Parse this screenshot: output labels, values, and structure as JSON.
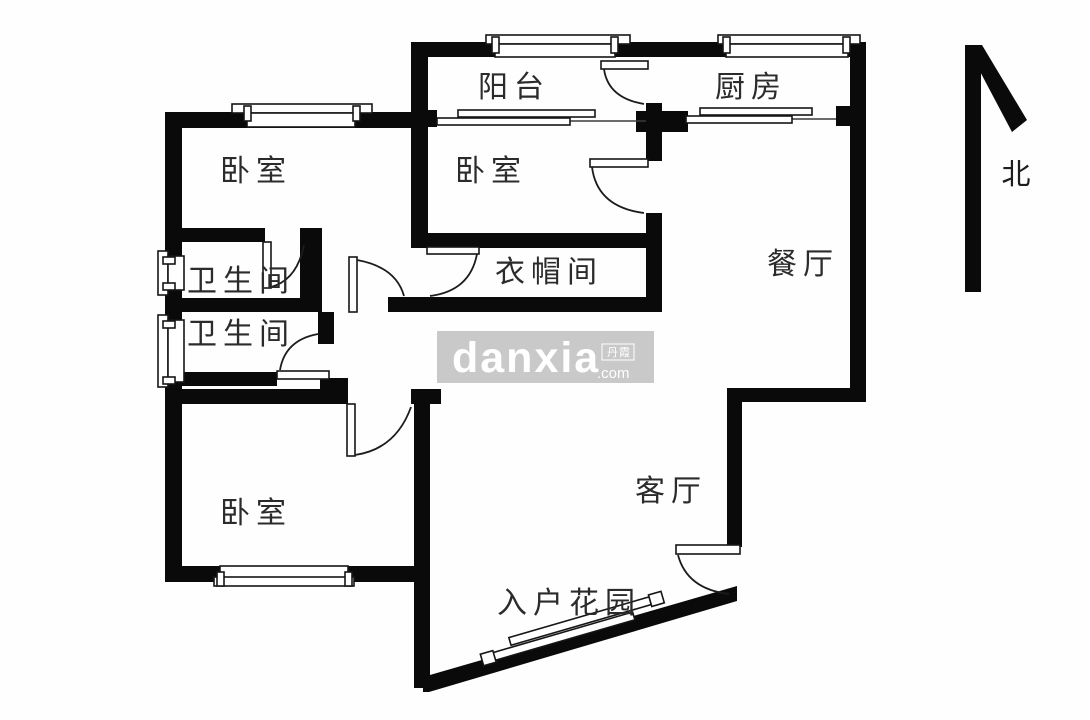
{
  "page": {
    "type": "apartment-floor-plan"
  },
  "compass": {
    "label": "北"
  },
  "watermark": {
    "brand": "danxia",
    "suffix": ".com",
    "cjk": "丹霞",
    "bg_color": "#c9c9c9",
    "text_color": "#ffffff"
  },
  "colors": {
    "wall": "#0a0a0a",
    "line": "#1c1c1c",
    "label": "#2b2b2b",
    "background": "#ffffff"
  },
  "rooms": [
    {
      "id": "balcony",
      "label": "阳台"
    },
    {
      "id": "kitchen",
      "label": "厨房"
    },
    {
      "id": "bedroom-top-left",
      "label": "卧室"
    },
    {
      "id": "bedroom-top-center",
      "label": "卧室"
    },
    {
      "id": "dining-room",
      "label": "餐厅"
    },
    {
      "id": "walk-in-closet",
      "label": "衣帽间"
    },
    {
      "id": "bathroom-upper",
      "label": "卫生间"
    },
    {
      "id": "bathroom-lower",
      "label": "卫生间"
    },
    {
      "id": "bedroom-bottom-left",
      "label": "卧室"
    },
    {
      "id": "living-room",
      "label": "客厅"
    },
    {
      "id": "entry-garden",
      "label": "入户花园"
    }
  ]
}
